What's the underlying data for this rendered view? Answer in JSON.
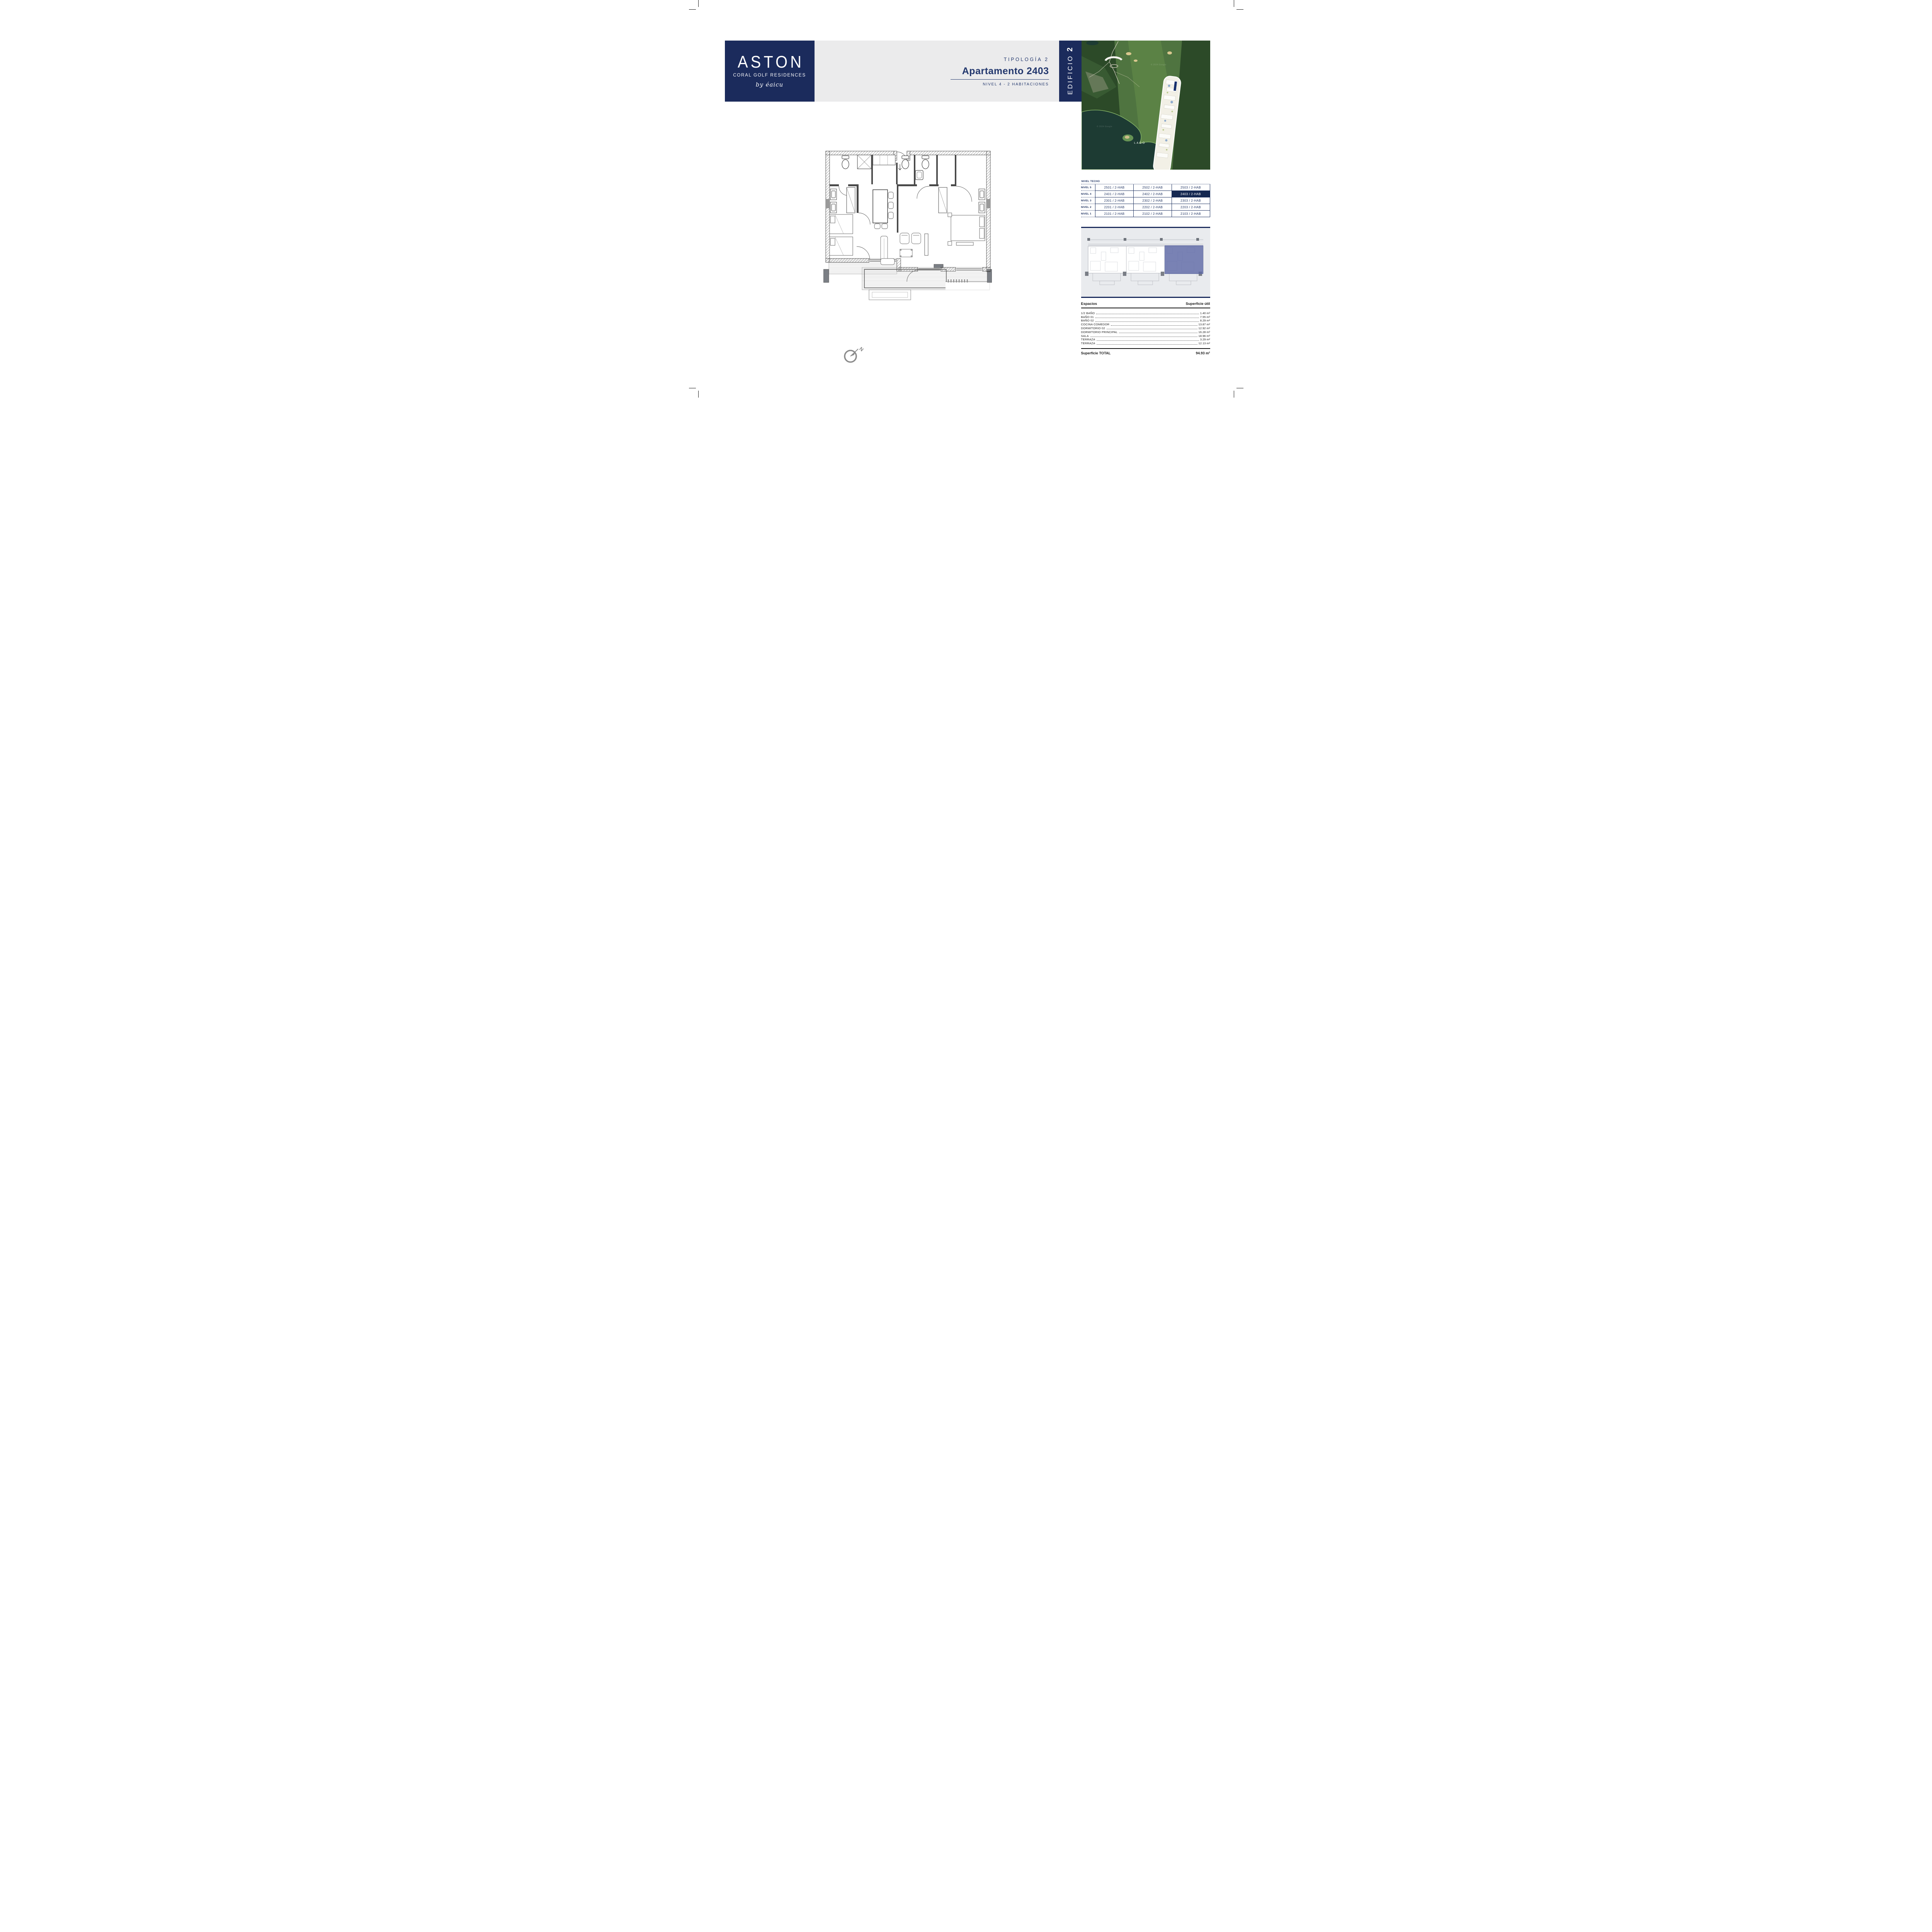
{
  "logo": {
    "brand": "ASTON",
    "subtitle": "CORAL GOLF RESIDENCES",
    "byline": "by éaicu"
  },
  "header": {
    "typology": "TIPOLOGÍA 2",
    "title": "Apartamento 2403",
    "level_info": "NIVEL 4 - 2 HABITACIONES",
    "building_word": "EDIFICIO",
    "building_number": "2"
  },
  "map": {
    "lake_label": "LAGO",
    "watermark": "© 2024 Google"
  },
  "levels_table": {
    "corner_label": "NIVEL TECHO",
    "rows": [
      {
        "label": "NIVEL 5",
        "cells": [
          "2501 / 2-HAB",
          "2502 / 2-HAB",
          "2503 / 2-HAB"
        ]
      },
      {
        "label": "NIVEL 4",
        "cells": [
          "2401 / 2-HAB",
          "2402 / 2-HAB",
          "2403 / 2-HAB"
        ]
      },
      {
        "label": "NIVEL 3",
        "cells": [
          "2301 / 2-HAB",
          "2302 / 2-HAB",
          "2303 / 2-HAB"
        ]
      },
      {
        "label": "NIVEL 2",
        "cells": [
          "2201 / 2-HAB",
          "2202 / 2-HAB",
          "2203 / 2-HAB"
        ]
      },
      {
        "label": "NIVEL 1",
        "cells": [
          "2101 / 2-HAB",
          "2102 / 2-HAB",
          "2103 / 2-HAB"
        ]
      }
    ],
    "highlighted_cell": "2403 / 2-HAB"
  },
  "spaces_table": {
    "col_space": "Espacios",
    "col_area": "Superficie útil",
    "rows": [
      {
        "name": "1/2 BAÑO",
        "value": "1.40 m²"
      },
      {
        "name": "BAÑO 01",
        "value": "7.55 m²"
      },
      {
        "name": "BAÑO 02",
        "value": "8.29 m²"
      },
      {
        "name": "COCINA COMEDOR",
        "value": "13.87 m²"
      },
      {
        "name": "DORMITORIO 02",
        "value": "12.92 m²"
      },
      {
        "name": "DORMITORIO PRINCIPAL",
        "value": "16.28 m²"
      },
      {
        "name": "SALA",
        "value": "18.96 m²"
      },
      {
        "name": "TERRAZA",
        "value": "3.29 m²"
      },
      {
        "name": "TERRAZA",
        "value": "12.13 m²"
      }
    ],
    "total_label": "Superficie TOTAL",
    "total_value": "94.93 m²"
  },
  "colors": {
    "brand_navy": "#1b2b5c",
    "highlight_navy": "#152851",
    "band_gray": "#ebebec",
    "panel_gray": "#e9ebee",
    "unit_highlight_purple": "#5c66a3"
  }
}
